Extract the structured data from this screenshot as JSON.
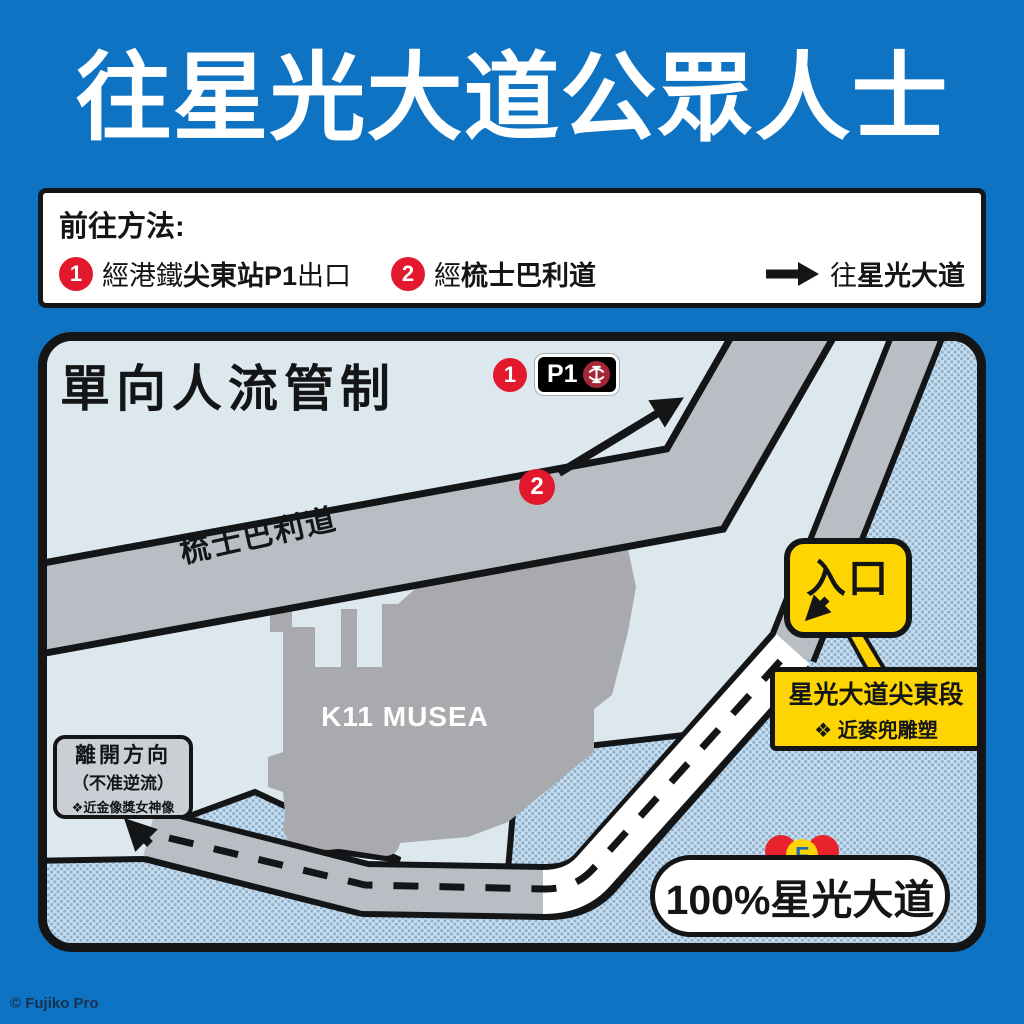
{
  "title": "往星光大道公眾人士",
  "instructions": {
    "heading": "前往方法:",
    "steps": [
      {
        "num": "1",
        "pre": "經港鐵",
        "bold": "尖東站P1",
        "post": "出口"
      },
      {
        "num": "2",
        "pre": "經",
        "bold": "梳士巴利道",
        "post": ""
      }
    ],
    "dest_pre": "往",
    "dest_bold": "星光大道"
  },
  "map": {
    "heading": "單向人流管制",
    "p1": {
      "num": "1",
      "label": "P1"
    },
    "marker2": "2",
    "road_label": "梳士巴利道",
    "building_label": "K11 MUSEA",
    "entrance_label": "入口",
    "entrance_info": {
      "line1": "星光大道尖東段",
      "line2": "❖ 近麥兜雕塑"
    },
    "exit_sign": {
      "line1": "離開方向",
      "line2": "（不准逆流）",
      "line3": "❖近金像獎女神像"
    },
    "pill": {
      "label": "100%星光大道",
      "logo_letter": "F"
    }
  },
  "footer": {
    "copyright": "© Fujiko Pro"
  },
  "colors": {
    "blue": "#0d73c2",
    "ink": "#131517",
    "land": "#dce8ee",
    "roadgray": "#b8bec3",
    "bldg": "#a8aaad",
    "yellow": "#fed500",
    "red": "#e2182d",
    "signgray": "#c9cfd4",
    "mtr": "#a32638",
    "waterbg": "#c6ddf0",
    "waterdot": "#8fb0ca",
    "logoblue": "#1e6cb8",
    "copy": "#16324f"
  }
}
